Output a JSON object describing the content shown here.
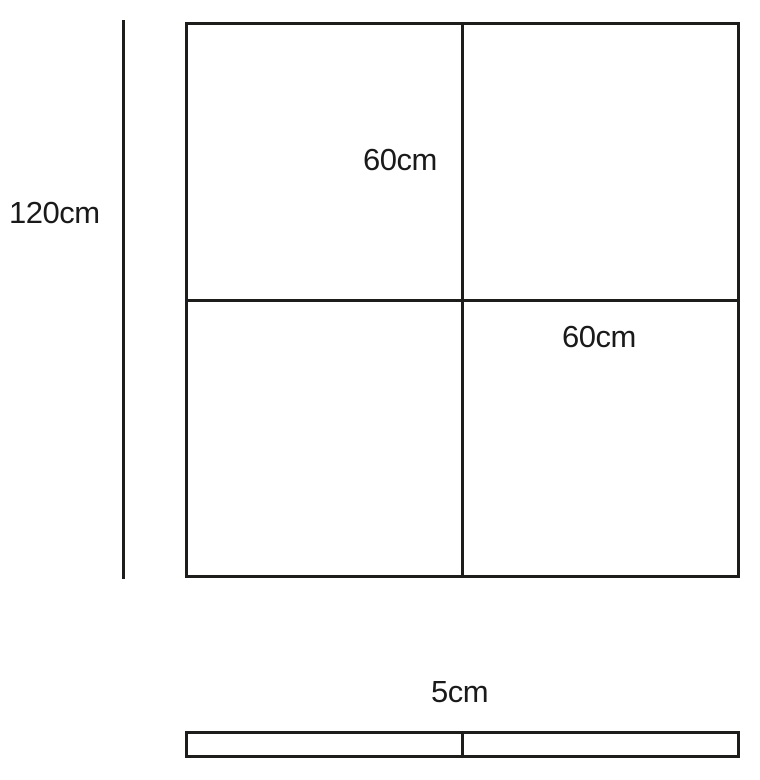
{
  "front_view": {
    "height_label": "120cm",
    "top_width_label": "60cm",
    "bottom_width_label": "60cm",
    "panels_rows": 2,
    "panels_cols": 2
  },
  "side_view": {
    "depth_label": "5cm",
    "sections": 2
  },
  "colors": {
    "line": "#1d1d1b",
    "text": "#1a1a1a",
    "background": "#ffffff"
  }
}
